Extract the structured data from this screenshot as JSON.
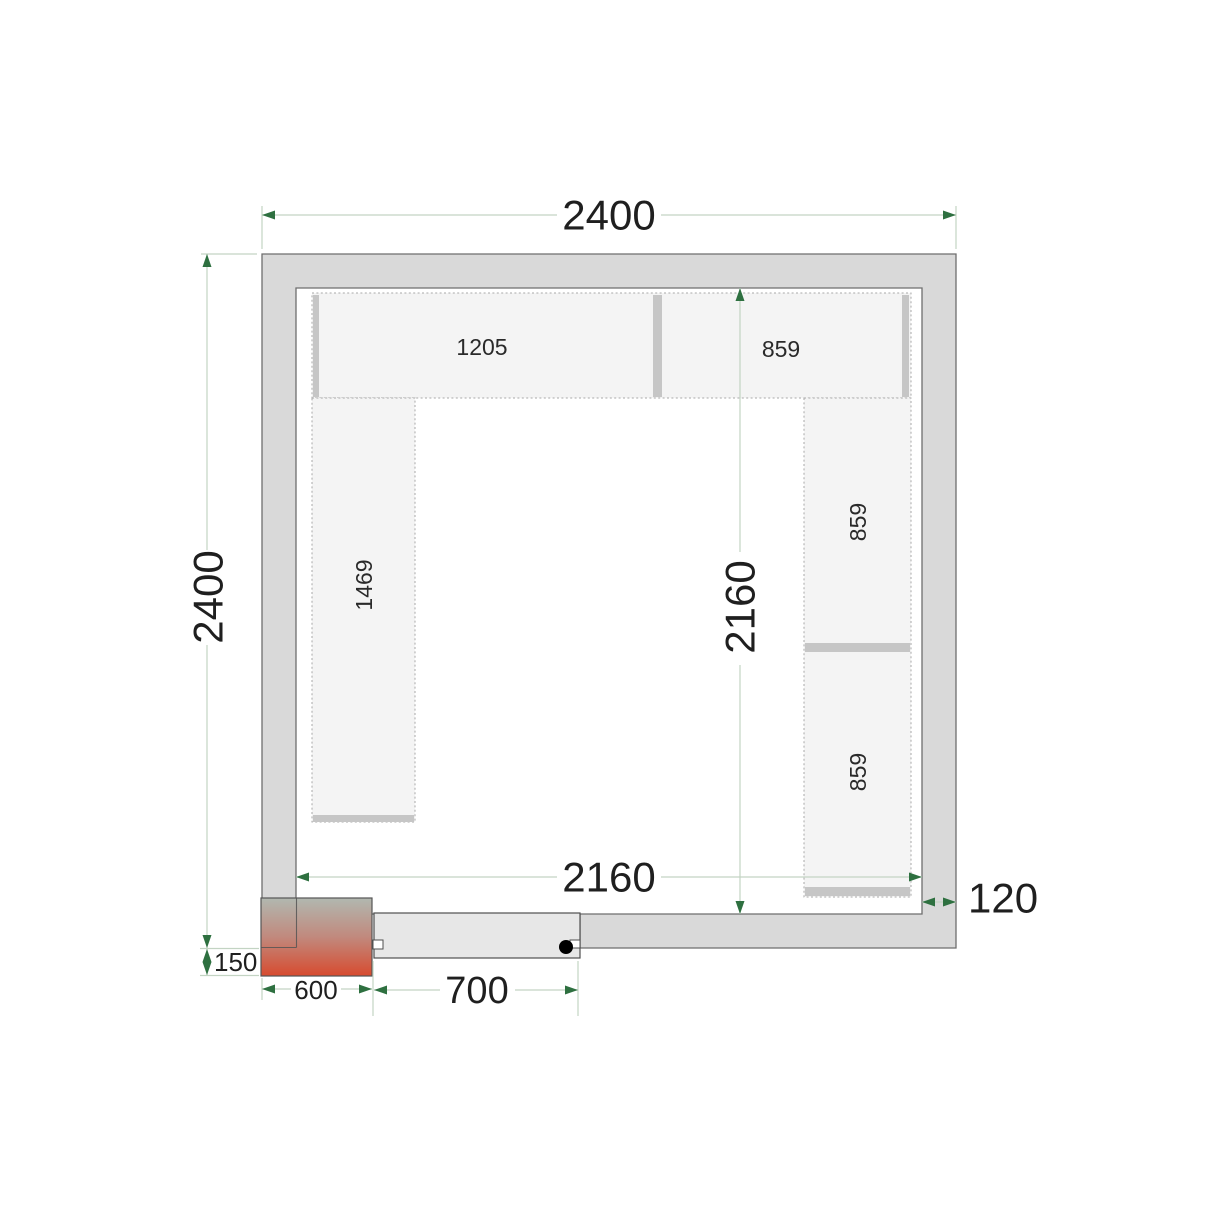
{
  "drawing": {
    "type": "cold-room-floor-plan",
    "dimensions": {
      "outer_width": "2400",
      "outer_depth": "2400",
      "inner_width": "2160",
      "inner_depth": "2160",
      "wall_thickness": "120",
      "unit_drop": "150",
      "unit_width": "600",
      "door_width": "700"
    },
    "shelves": {
      "top_left_label": "1205",
      "top_right_label": "859",
      "left_label": "1469",
      "right_upper_label": "859",
      "right_lower_label": "859"
    },
    "colors": {
      "wall_fill": "#d9d9d9",
      "wall_stroke": "#6e6e6e",
      "shelf_fill": "#f4f4f4",
      "shelf_border": "#a9a9a9",
      "shelf_bar": "#c6c6c6",
      "door_fill": "#e7e7e7",
      "door_handle": "#000000",
      "dim_line": "#c3d4c3",
      "dim_arrow": "#2e7040",
      "text": "#1f1f1f",
      "unit_gradient_top": "#b1b8b0",
      "unit_gradient_mid": "#c1897d",
      "unit_gradient_bottom": "#d74b2f"
    }
  }
}
